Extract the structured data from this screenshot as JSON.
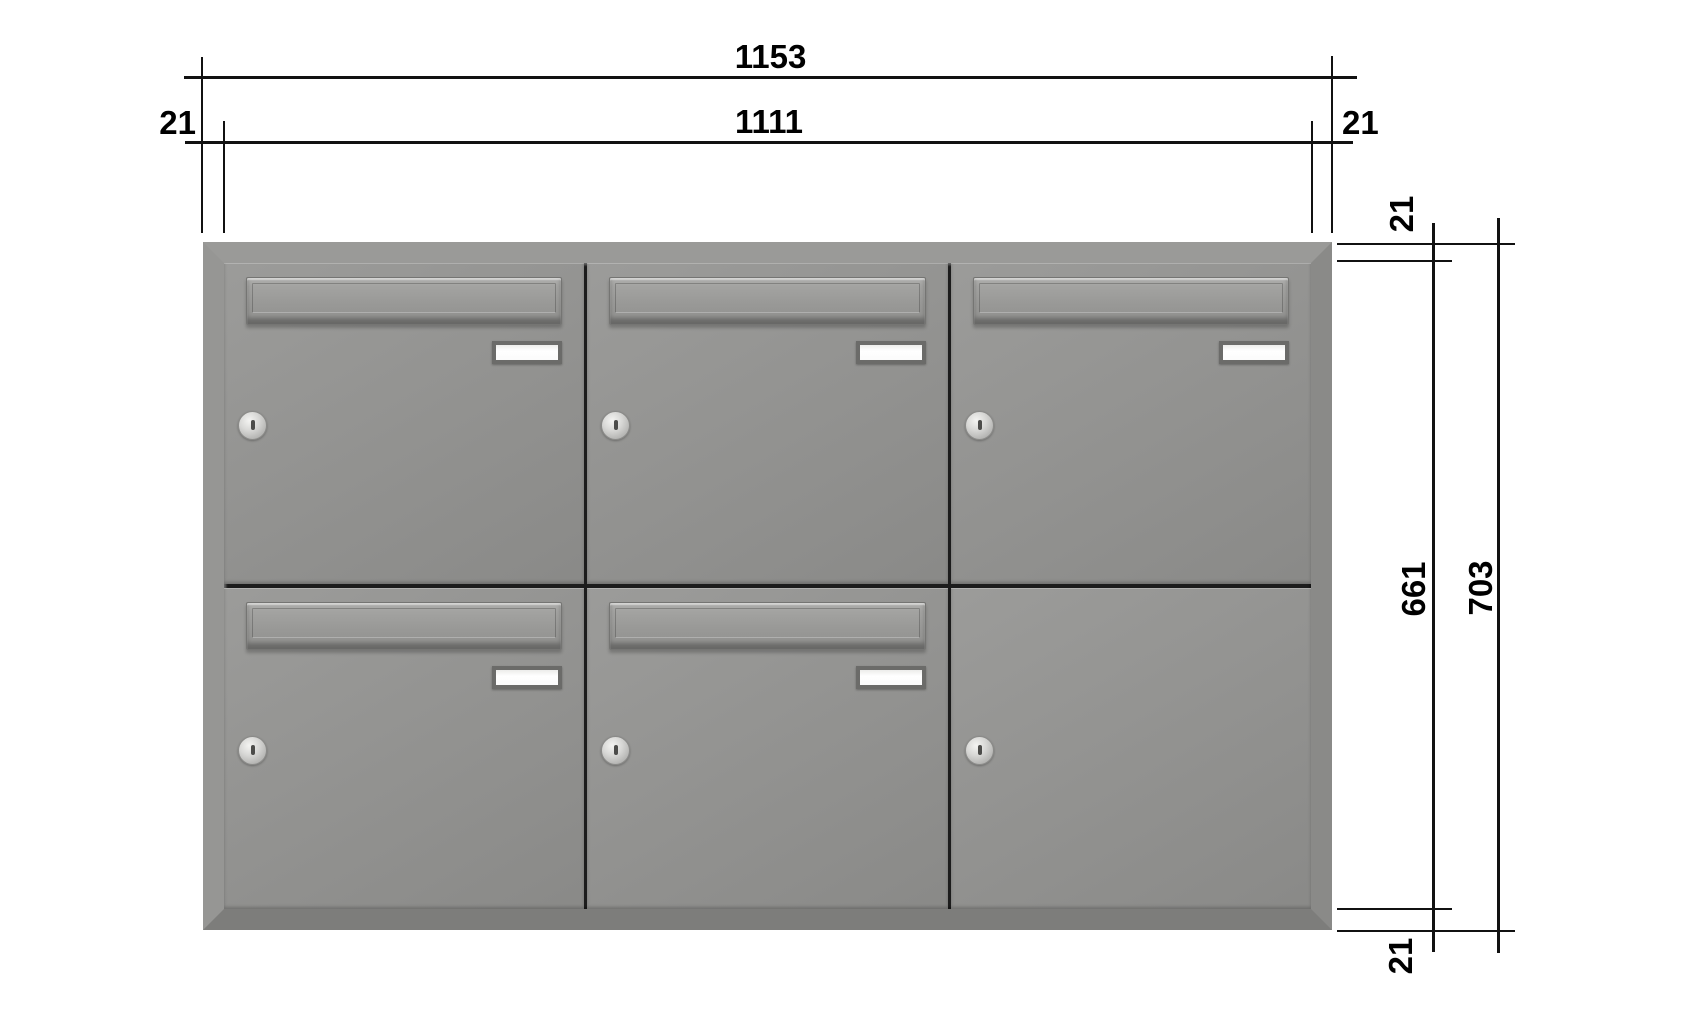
{
  "dimensions": {
    "outer_width": "1153",
    "inner_width": "1111",
    "left_margin": "21",
    "right_margin": "21",
    "top_margin": "21",
    "inner_height": "661",
    "outer_height": "703",
    "bottom_margin": "21"
  },
  "cabinet": {
    "rows": 2,
    "cols": 3,
    "boxes": [
      {
        "id": "box-1",
        "row": 1,
        "col": 1,
        "has_flap": true,
        "has_name_plate": true,
        "has_lock": true
      },
      {
        "id": "box-2",
        "row": 1,
        "col": 2,
        "has_flap": true,
        "has_name_plate": true,
        "has_lock": true
      },
      {
        "id": "box-3",
        "row": 1,
        "col": 3,
        "has_flap": true,
        "has_name_plate": true,
        "has_lock": true
      },
      {
        "id": "box-4",
        "row": 2,
        "col": 1,
        "has_flap": true,
        "has_name_plate": true,
        "has_lock": true
      },
      {
        "id": "box-5",
        "row": 2,
        "col": 2,
        "has_flap": true,
        "has_name_plate": true,
        "has_lock": true
      },
      {
        "id": "box-6",
        "row": 2,
        "col": 3,
        "has_flap": false,
        "has_name_plate": false,
        "has_lock": true
      }
    ],
    "colors": {
      "frame_top": "#9a9a98",
      "frame_left": "#969694",
      "frame_right": "#8a8a88",
      "frame_bottom": "#7d7d7b",
      "door_face": "#949492",
      "divider": "#1c1c1c",
      "name_plate": "#ffffff",
      "lock_silver": "#d7d7d5",
      "dimension_line": "#111111"
    }
  }
}
